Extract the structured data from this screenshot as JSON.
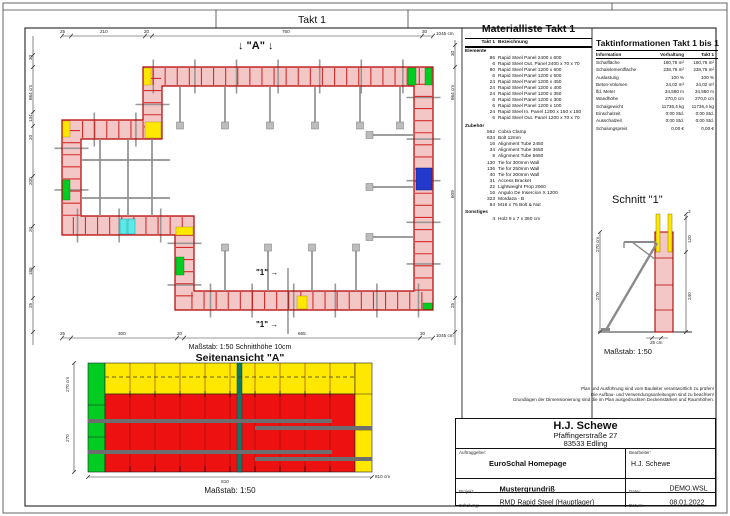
{
  "top_label": "Takt 1",
  "colors": {
    "panel_fill": "#f4c7c7",
    "panel_edge": "#c00000",
    "elev_red": "#ee1111",
    "elev_yellow": "#ffe800",
    "elev_green": "#00cc22",
    "elev_teal": "#0b7a6a",
    "accent_blue": "#2239cc",
    "accent_cyan": "#5fe8e8",
    "tie_gray": "#8f8f8f"
  },
  "plan": {
    "view_marker": "↓ \"A\" ↓",
    "section_label_1": "\"1\" →",
    "section_label_2": "\"1\" →",
    "dims_top": [
      "25",
      "210",
      "20",
      "760",
      "30"
    ],
    "dims_top_total": "1045 cm",
    "dims_bottom": [
      "25",
      "300",
      "20",
      "665",
      "30"
    ],
    "dims_bottom_total": "1045 cm",
    "dims_left": [
      "30",
      "134",
      "20",
      "200",
      "20",
      "185",
      "25"
    ],
    "dims_left_total": "664 cm",
    "dims_right": [
      "30",
      "609",
      "25"
    ],
    "dims_right_total": "664 cm",
    "scale_note": "Maßstab: 1:50   Schnitthöhe 10cm"
  },
  "materialliste": {
    "title": "Materialliste  Takt 1",
    "col_qty": "Takt 1",
    "col_name": "Bezeichnung",
    "group1": "Elemente",
    "elemente": [
      {
        "q": "86",
        "n": "Rapid Steel Panel 2400 x 600"
      },
      {
        "q": "6",
        "n": "Rapid Steel Out. Panel 2400 x 70 x 70"
      },
      {
        "q": "80",
        "n": "Rapid Steel Panel 1200 x 600"
      },
      {
        "q": "6",
        "n": "Rapid Steel Panel 1200 x 500"
      },
      {
        "q": "24",
        "n": "Rapid Steel Panel 1200 x 450"
      },
      {
        "q": "24",
        "n": "Rapid Steel Panel 1200 x 400"
      },
      {
        "q": "24",
        "n": "Rapid Steel Panel 1200 x 350"
      },
      {
        "q": "6",
        "n": "Rapid Steel Panel 1200 x 300"
      },
      {
        "q": "6",
        "n": "Rapid Steel Panel 1200 x 100"
      },
      {
        "q": "24",
        "n": "Rapid Steel In. Panel 1200 x 150 x 150"
      },
      {
        "q": "6",
        "n": "Rapid Steel Out. Panel 1200 x 70 x 70"
      }
    ],
    "group2": "Zubehör",
    "zubehoer": [
      {
        "q": "562",
        "n": "Cobra Clamp"
      },
      {
        "q": "634",
        "n": "Bolt 12mm"
      },
      {
        "q": "16",
        "n": "Alignment Tube 2450"
      },
      {
        "q": "34",
        "n": "Alignment Tube 3650"
      },
      {
        "q": "9",
        "n": "Alignment Tube 5650"
      },
      {
        "q": "130",
        "n": "Tie for 300mm Wall"
      },
      {
        "q": "136",
        "n": "Tie for 250mm Wall"
      },
      {
        "q": "40",
        "n": "Tie for 200mm Wall"
      },
      {
        "q": "31",
        "n": "Access Bracket"
      },
      {
        "q": "22",
        "n": "Lightweight Prop 2060"
      },
      {
        "q": "16",
        "n": "Angulo De Insercion X 1200"
      },
      {
        "q": "323",
        "n": "Mordaza - B"
      },
      {
        "q": "84",
        "n": "M16 x 75 Bolt & Nut"
      }
    ],
    "group3": "Sonstiges",
    "sonstiges": [
      {
        "q": "4",
        "n": "Holz 9 x 7 x 360 cm"
      }
    ]
  },
  "taktinfo": {
    "title": "Taktinformationen  Takt 1 bis 1",
    "col_info": "Information",
    "col_vorhaltung": "Vorhaltung",
    "col_takt": "Takt 1",
    "rows": [
      {
        "k": "Schalfläche",
        "a": "180,76 m²",
        "b": "180,76 m²"
      },
      {
        "k": "Schalelementfläche",
        "a": "238,76 m²",
        "b": "238,76 m²"
      },
      {
        "k": "Auslastung",
        "a": "100 %",
        "b": "100 %"
      },
      {
        "k": "Beton-Volumen",
        "a": "24,02 m³",
        "b": "24,02 m³"
      },
      {
        "k": "lfd. Meter",
        "a": "34,580 m",
        "b": "34,580 m"
      },
      {
        "k": "Wandhöhe",
        "a": "270,0 cm",
        "b": "270,0 cm"
      },
      {
        "k": "Schalgewicht",
        "a": "11736,4 kg",
        "b": "11736,4 kg"
      },
      {
        "k": "Einschalzeit",
        "a": "0:00 Std.",
        "b": "0:00 Std."
      },
      {
        "k": "Ausschalzeit",
        "a": "0:00 Std.",
        "b": "0:00 Std."
      },
      {
        "k": "Schalungspreis",
        "a": "0,00 €",
        "b": "0,00 €"
      }
    ]
  },
  "schnitt": {
    "title": "Schnitt \"1\"",
    "dim_left_total": "270 cm",
    "dim_left": "270",
    "dim_right_top": "3",
    "dim_right_1": "120",
    "dim_right_2": "240",
    "dim_width": "25 cm",
    "scale": "Maßstab: 1:50"
  },
  "seitenansicht": {
    "title": "Seitenansicht \"A\"",
    "dim_left_total": "270 cm",
    "dim_left": "270",
    "dim_bottom": "810",
    "dim_bottom_total": "810 cm",
    "scale": "Maßstab: 1:50"
  },
  "notes": [
    "Plan und Ausführung sind vom Bauleiter verantwortlich zu prüfen!",
    "Die Aufbau- und Verwendungsanleitungen sind zu beachten!",
    "Grundlagen der Dimensionierung sind die im Plan ausgedruckten Deckenstärken und Raumhöhen."
  ],
  "titleblock": {
    "company": "H.J. Schewe",
    "street": "Pfaffingerstraße 27",
    "city": "83533 Edling",
    "auftraggeber_label": "Auftraggeber:",
    "auftraggeber": "EuroSchal Homepage",
    "bearbeiter_label": "Bearbeiter:",
    "bearbeiter": "H.J. Schewe",
    "projekt_label": "Projekt:",
    "projekt": "Mustergrundriß",
    "datei_label": "Datei:",
    "datei": "DEMO.WSL",
    "schalung_label": "Schalung:",
    "schalung": "RMD Rapid Steel (Hauptlager)",
    "datum_label": "Datum:",
    "datum": "08.01.2022"
  }
}
